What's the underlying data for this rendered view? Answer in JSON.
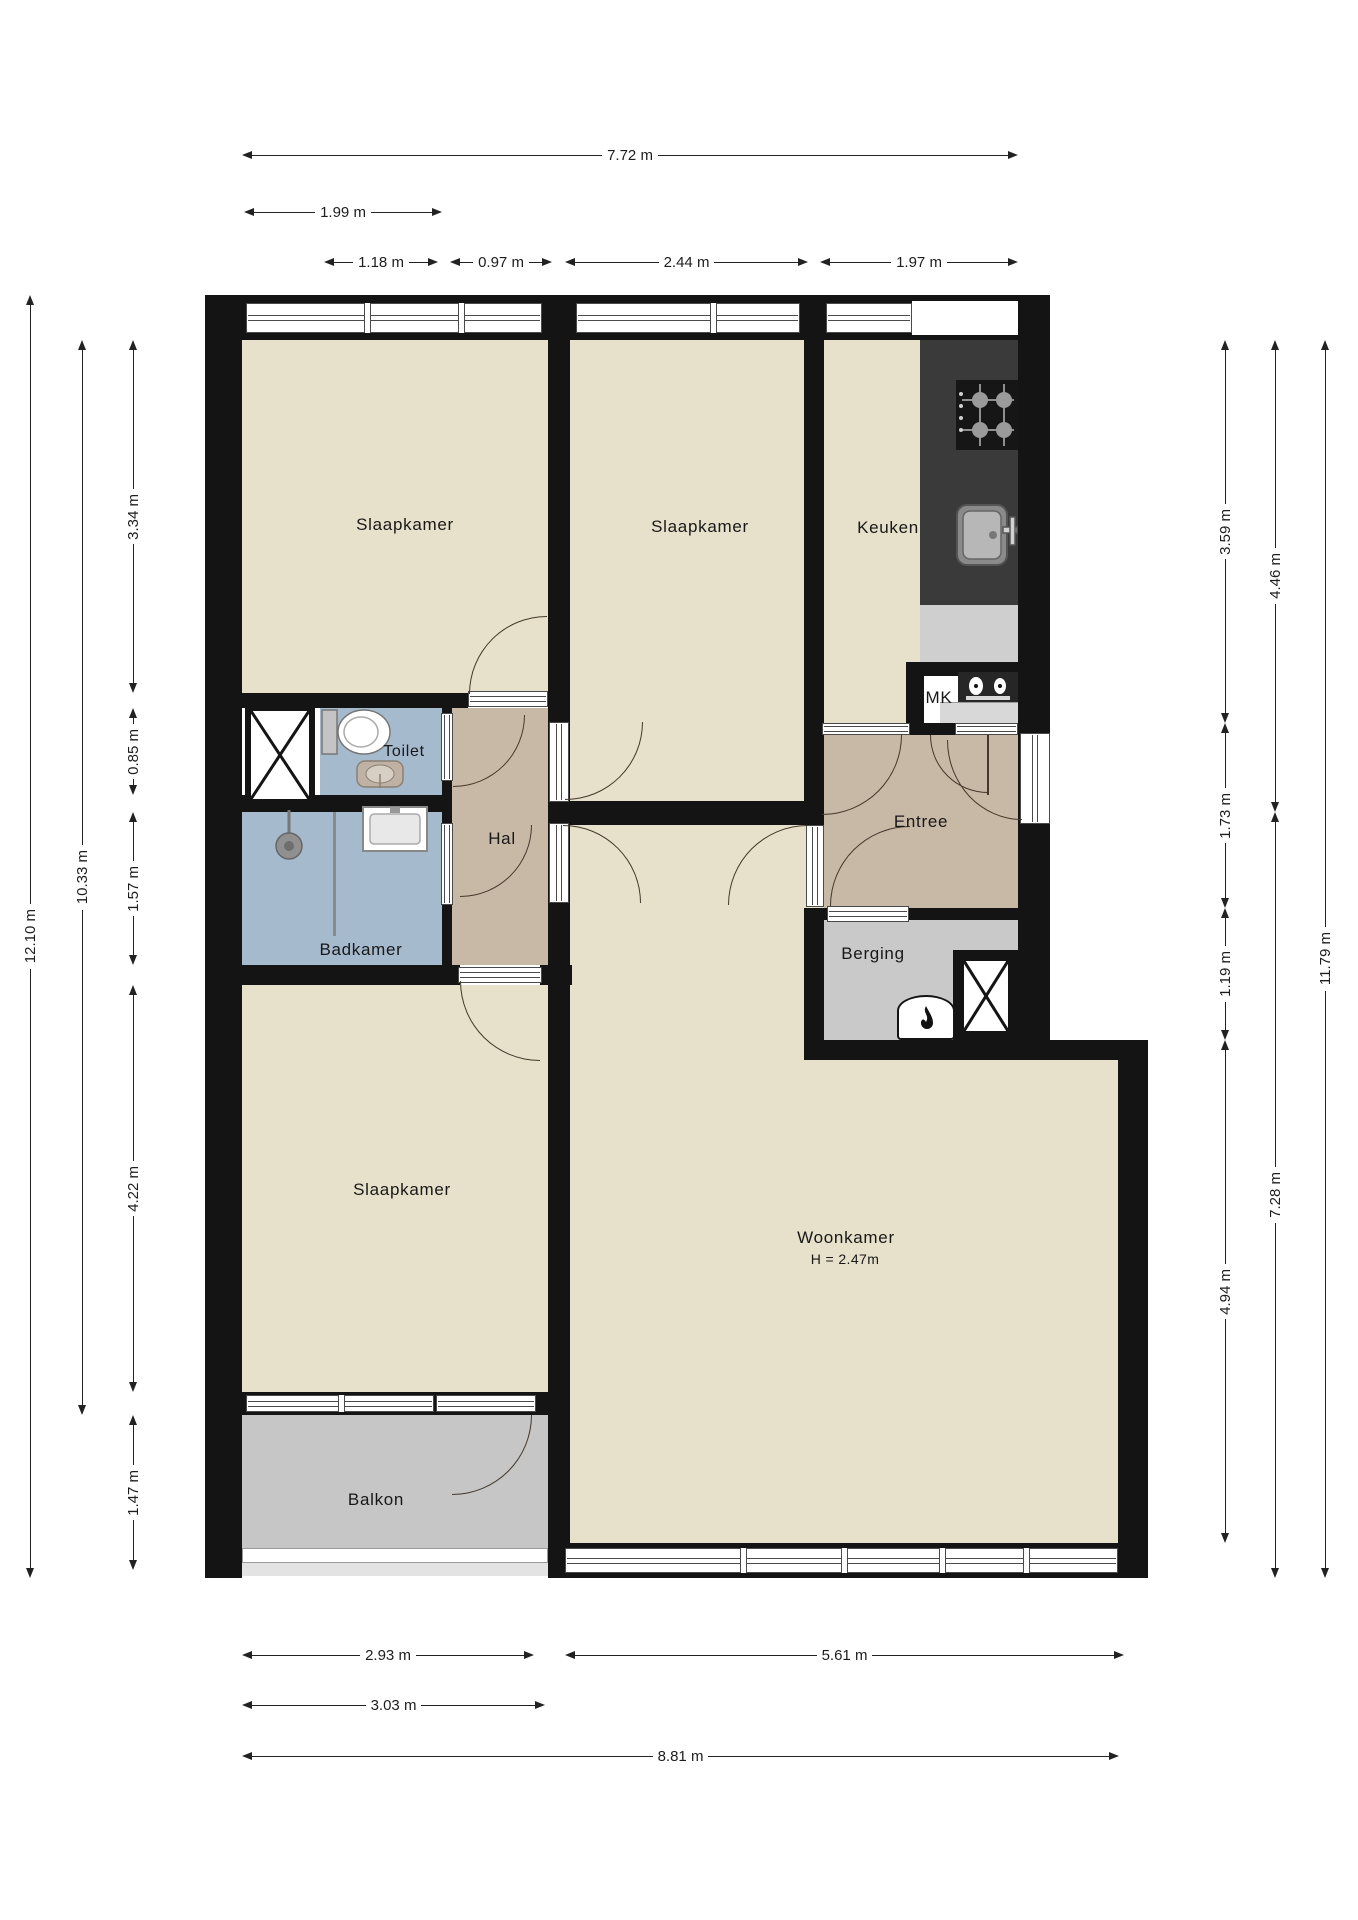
{
  "plan_type": "floorplan",
  "colors": {
    "wall": "#141414",
    "room_floor": "#e7e0ca",
    "wet_room_floor": "#a6bace",
    "hall_floor": "#c8b9a7",
    "outdoor_floor": "#c6c6c6",
    "storage_floor": "#c9c9c9",
    "counter_dark": "#3a3a3a",
    "counter_light": "#cfcfcf",
    "dimension_text": "#1d1d1d"
  },
  "rooms": {
    "slaapkamer1": "Slaapkamer",
    "slaapkamer2": "Slaapkamer",
    "keuken": "Keuken",
    "toilet": "Toilet",
    "hal": "Hal",
    "mk": "MK",
    "entree": "Entree",
    "badkamer": "Badkamer",
    "berging": "Berging",
    "slaapkamer3": "Slaapkamer",
    "woonkamer": "Woonkamer",
    "woonkamer_height": "H = 2.47m",
    "balkon": "Balkon"
  },
  "dimensions": {
    "top": [
      "7.72 m",
      "1.99 m",
      "1.18 m",
      "0.97 m",
      "2.44 m",
      "1.97 m"
    ],
    "left": [
      "12.10 m",
      "10.33 m",
      "3.34 m",
      "0.85 m",
      "1.57 m",
      "4.22 m",
      "1.47 m"
    ],
    "right": [
      "3.59 m",
      "1.73 m",
      "1.19 m",
      "4.94 m",
      "4.46 m",
      "7.28 m",
      "11.79 m"
    ],
    "bottom": [
      "2.93 m",
      "5.61 m",
      "3.03 m",
      "8.81 m"
    ]
  },
  "fixtures": [
    "gas-hob-icon",
    "kitchen-sink-icon",
    "meter-panel-icon",
    "toilet-icon",
    "hand-basin-icon",
    "washbasin-icon",
    "shower-head-icon",
    "shower-screen",
    "boiler-icon",
    "shaft-cross-icon",
    "shaft-cross-icon"
  ]
}
